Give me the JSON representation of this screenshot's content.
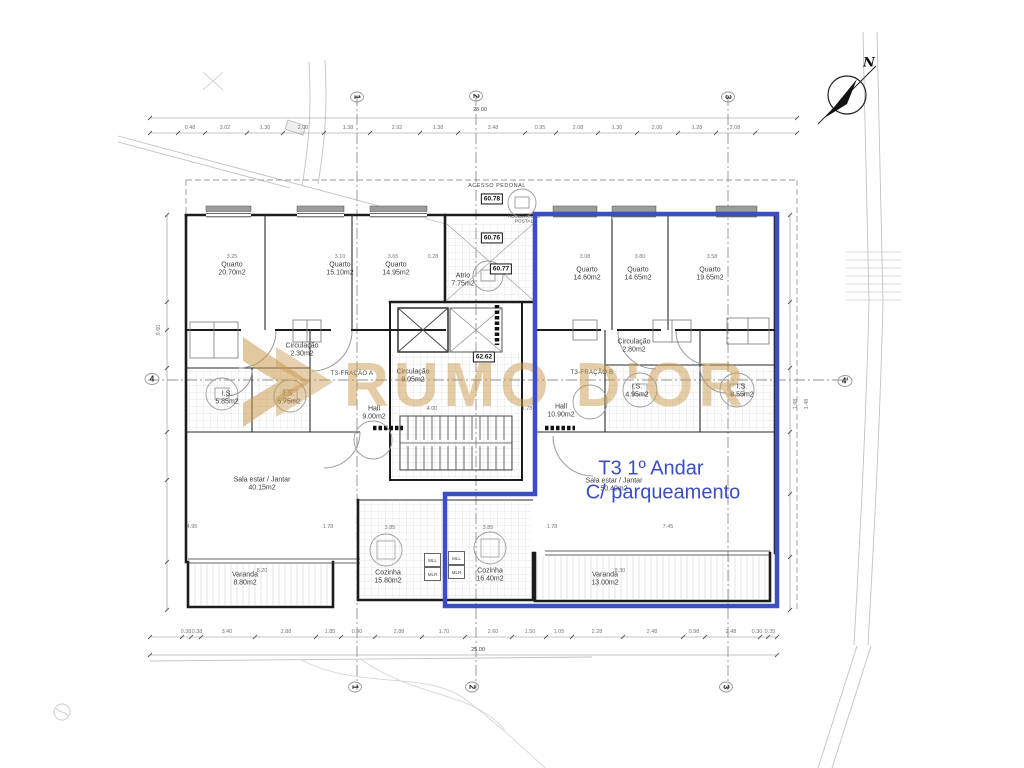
{
  "plan": {
    "colors": {
      "accent": "#3b4ec4",
      "watermark_gold": "#c99a4f"
    },
    "watermark": {
      "brand": "RUMO D'OR"
    },
    "highlight": {
      "line1": "T3 1º Andar",
      "line2": "C/ parqueamento"
    },
    "north_label": "N",
    "annotations": {
      "acesso": "ACESSO PEDONAL",
      "recetaculo_l1": "RECETÁCULO",
      "recetaculo_l2": "POSTAL",
      "fracao_a": "T3-FRAÇÃO A",
      "fracao_b": "T3-FRAÇÃO B",
      "lev1": "60.78",
      "lev2": "60.76",
      "lev3": "60.77",
      "lev4": "62.62",
      "total_top": "25.00",
      "total_bottom": "25.00"
    },
    "grid": {
      "g1": "1",
      "g2": "2",
      "g3": "3",
      "g4": "4",
      "g4p": "4'"
    },
    "appliances": {
      "mll": "MLL",
      "mlr": "MLR"
    },
    "rooms": [
      {
        "name": "Quarto",
        "area": "20.70m2"
      },
      {
        "name": "Quarto",
        "area": "15.10m2"
      },
      {
        "name": "Quarto",
        "area": "14.95m2"
      },
      {
        "name": "Atrio",
        "area": "7.75m2"
      },
      {
        "name": "Circulação",
        "area": "2.30m2"
      },
      {
        "name": "Circulação",
        "area": "9.05m2"
      },
      {
        "name": "I.S.",
        "area": "5.85m2"
      },
      {
        "name": "I.S.",
        "area": "5.75m2"
      },
      {
        "name": "Hall",
        "area": "9.00m2"
      },
      {
        "name": "Sala estar / Jantar",
        "area": "40.15m2"
      },
      {
        "name": "Varanda",
        "area": "8.80m2"
      },
      {
        "name": "Cozinha",
        "area": "15.80m2"
      },
      {
        "name": "Quarto",
        "area": "14.60m2"
      },
      {
        "name": "Quarto",
        "area": "14.65m2"
      },
      {
        "name": "Quarto",
        "area": "19.65m2"
      },
      {
        "name": "Circulação",
        "area": "2.80m2"
      },
      {
        "name": "I.S.",
        "area": "4.95m2"
      },
      {
        "name": "I.S.",
        "area": "8.55m2"
      },
      {
        "name": "Hall",
        "area": "10.90m2"
      },
      {
        "name": "Sala estar / Jantar",
        "area": "50.40m2"
      },
      {
        "name": "Cozinha",
        "area": "16.40m2"
      },
      {
        "name": "Varanda",
        "area": "13.00m2"
      }
    ],
    "dims": {
      "top": [
        {
          "t": "0.48",
          "x": 190,
          "y": 128
        },
        {
          "t": "3.02",
          "x": 225,
          "y": 128
        },
        {
          "t": "1.30",
          "x": 265,
          "y": 128
        },
        {
          "t": "2.00",
          "x": 303,
          "y": 128
        },
        {
          "t": "1.38",
          "x": 348,
          "y": 128
        },
        {
          "t": "2.92",
          "x": 397,
          "y": 128
        },
        {
          "t": "1.38",
          "x": 438,
          "y": 128
        },
        {
          "t": "3.48",
          "x": 493,
          "y": 128
        },
        {
          "t": "0.95",
          "x": 540,
          "y": 128
        },
        {
          "t": "2.08",
          "x": 578,
          "y": 128
        },
        {
          "t": "1.30",
          "x": 617,
          "y": 128
        },
        {
          "t": "2.00",
          "x": 657,
          "y": 128
        },
        {
          "t": "1.28",
          "x": 697,
          "y": 128
        },
        {
          "t": "2.08",
          "x": 735,
          "y": 128
        }
      ],
      "bottom": [
        {
          "t": "0.38",
          "x": 186,
          "y": 632
        },
        {
          "t": "0.38",
          "x": 197,
          "y": 632
        },
        {
          "t": "3.40",
          "x": 227,
          "y": 632
        },
        {
          "t": "2.88",
          "x": 286,
          "y": 632
        },
        {
          "t": "1.85",
          "x": 330,
          "y": 632
        },
        {
          "t": "0.90",
          "x": 357,
          "y": 632
        },
        {
          "t": "2.88",
          "x": 399,
          "y": 632
        },
        {
          "t": "1.70",
          "x": 444,
          "y": 632
        },
        {
          "t": "2.60",
          "x": 493,
          "y": 632
        },
        {
          "t": "1.50",
          "x": 530,
          "y": 632
        },
        {
          "t": "1.05",
          "x": 559,
          "y": 632
        },
        {
          "t": "2.28",
          "x": 597,
          "y": 632
        },
        {
          "t": "2.48",
          "x": 652,
          "y": 632
        },
        {
          "t": "0.98",
          "x": 694,
          "y": 632
        },
        {
          "t": "2.48",
          "x": 731,
          "y": 632
        },
        {
          "t": "0.30",
          "x": 757,
          "y": 632
        },
        {
          "t": "0.35",
          "x": 770,
          "y": 632
        }
      ],
      "inner": [
        {
          "t": "3.25",
          "x": 232,
          "y": 257
        },
        {
          "t": "3.10",
          "x": 340,
          "y": 257
        },
        {
          "t": "3.65",
          "x": 393,
          "y": 257
        },
        {
          "t": "0.28",
          "x": 433,
          "y": 257
        },
        {
          "t": "3.08",
          "x": 585,
          "y": 257
        },
        {
          "t": "3.80",
          "x": 640,
          "y": 257
        },
        {
          "t": "3.58",
          "x": 712,
          "y": 257
        },
        {
          "t": "4.00",
          "x": 432,
          "y": 409
        },
        {
          "t": "1.78",
          "x": 527,
          "y": 409
        },
        {
          "t": "4.95",
          "x": 192,
          "y": 527
        },
        {
          "t": "1.78",
          "x": 328,
          "y": 527
        },
        {
          "t": "3.85",
          "x": 390,
          "y": 528
        },
        {
          "t": "3.85",
          "x": 488,
          "y": 528
        },
        {
          "t": "1.78",
          "x": 552,
          "y": 527
        },
        {
          "t": "7.45",
          "x": 668,
          "y": 527
        },
        {
          "t": "8.20",
          "x": 262,
          "y": 571
        },
        {
          "t": "8.30",
          "x": 620,
          "y": 571
        }
      ],
      "side": [
        {
          "t": "9.60",
          "x": 159,
          "y": 330,
          "r": -90
        },
        {
          "t": "1.98",
          "x": 796,
          "y": 404,
          "r": -90
        },
        {
          "t": "1.48",
          "x": 807,
          "y": 404,
          "r": -90
        }
      ]
    }
  }
}
